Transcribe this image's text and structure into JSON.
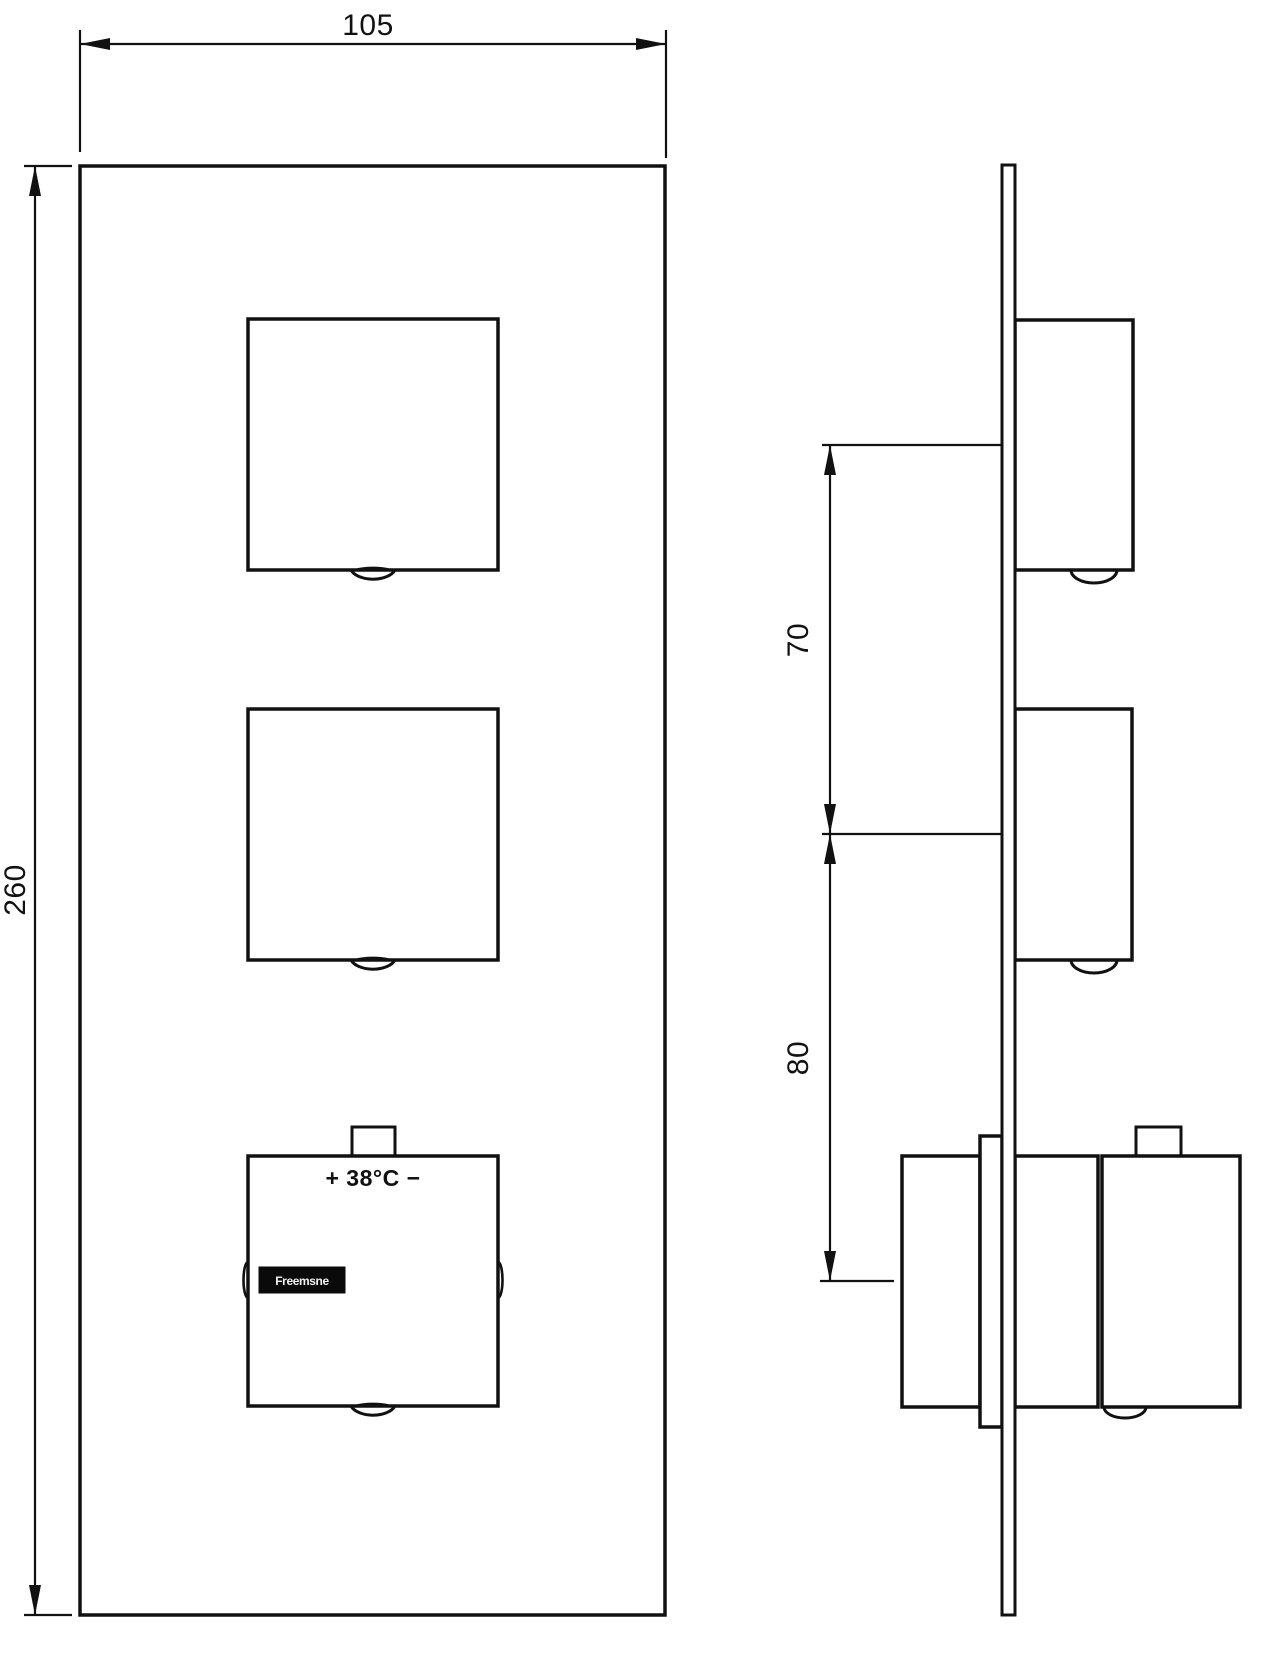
{
  "drawing": {
    "colors": {
      "background": "#ffffff",
      "line": "#111111",
      "logo_band_bg": "#0a0a0a",
      "logo_band_fg": "#f2f2f2"
    },
    "front_view": {
      "width_dimension": "105",
      "height_dimension": "260",
      "temperature_label": "+ 38°C −",
      "logo_text": "Freemsne"
    },
    "side_view": {
      "upper_handle_spacing_dimension": "70",
      "lower_handle_spacing_dimension": "80"
    }
  }
}
